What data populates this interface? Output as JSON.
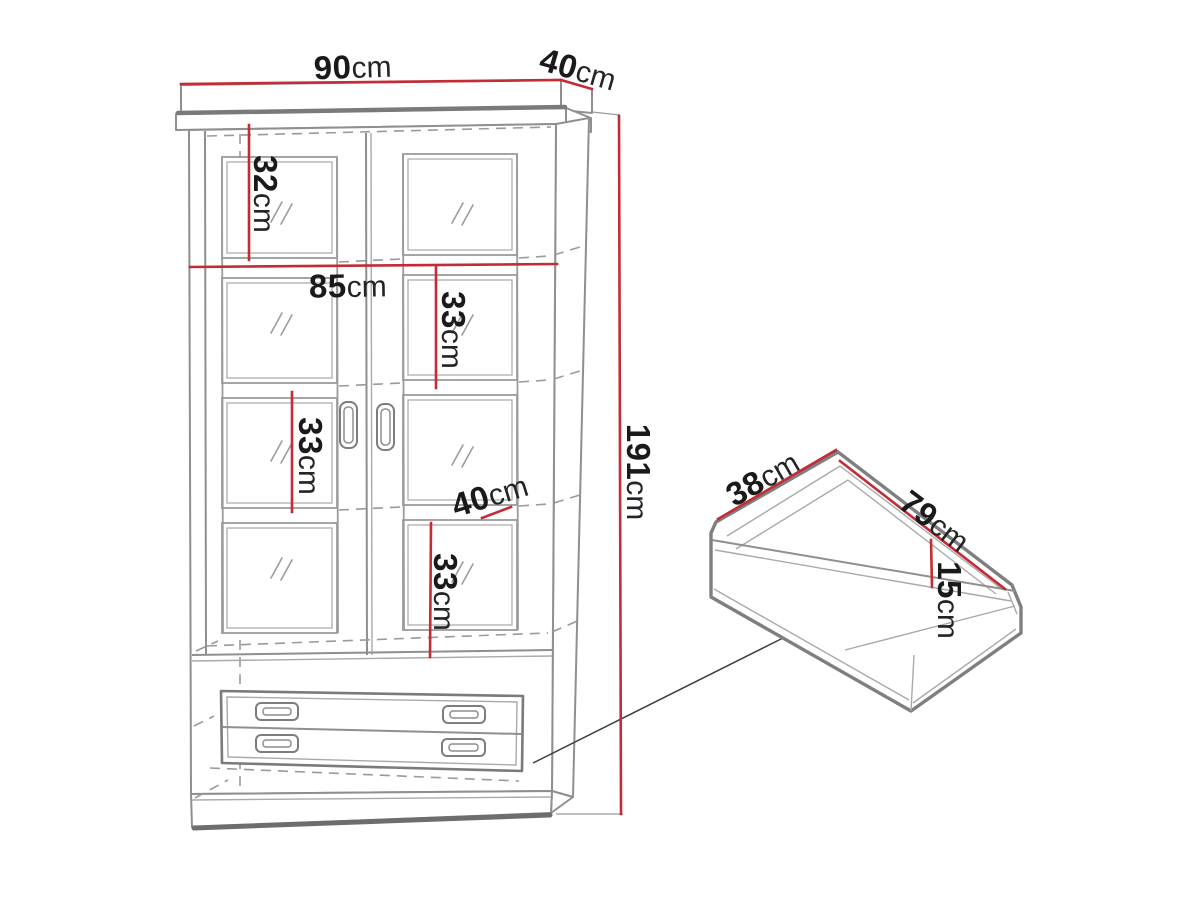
{
  "drawing": {
    "kind": "furniture-dimension-diagram",
    "colors": {
      "dimension_red": "#c32b35",
      "line_gray": "#8f8f8f",
      "text": "#1a1a1a"
    },
    "cabinet": {
      "description": "two-door glass display cabinet with two drawers",
      "dimensions": {
        "top_width": {
          "value": "90",
          "unit": "cm"
        },
        "top_depth": {
          "value": "40",
          "unit": "cm"
        },
        "top_section_height": {
          "value": "32",
          "unit": "cm"
        },
        "inner_width": {
          "value": "85",
          "unit": "cm"
        },
        "upper_shelf_height": {
          "value": "33",
          "unit": "cm"
        },
        "middle_shelf_height": {
          "value": "33",
          "unit": "cm"
        },
        "shelf_depth": {
          "value": "40",
          "unit": "cm"
        },
        "lower_shelf_height": {
          "value": "33",
          "unit": "cm"
        },
        "total_height": {
          "value": "191",
          "unit": "cm"
        }
      }
    },
    "drawer": {
      "description": "pull-out drawer box",
      "dimensions": {
        "depth": {
          "value": "38",
          "unit": "cm"
        },
        "width": {
          "value": "79",
          "unit": "cm"
        },
        "height": {
          "value": "15",
          "unit": "cm"
        }
      }
    }
  }
}
